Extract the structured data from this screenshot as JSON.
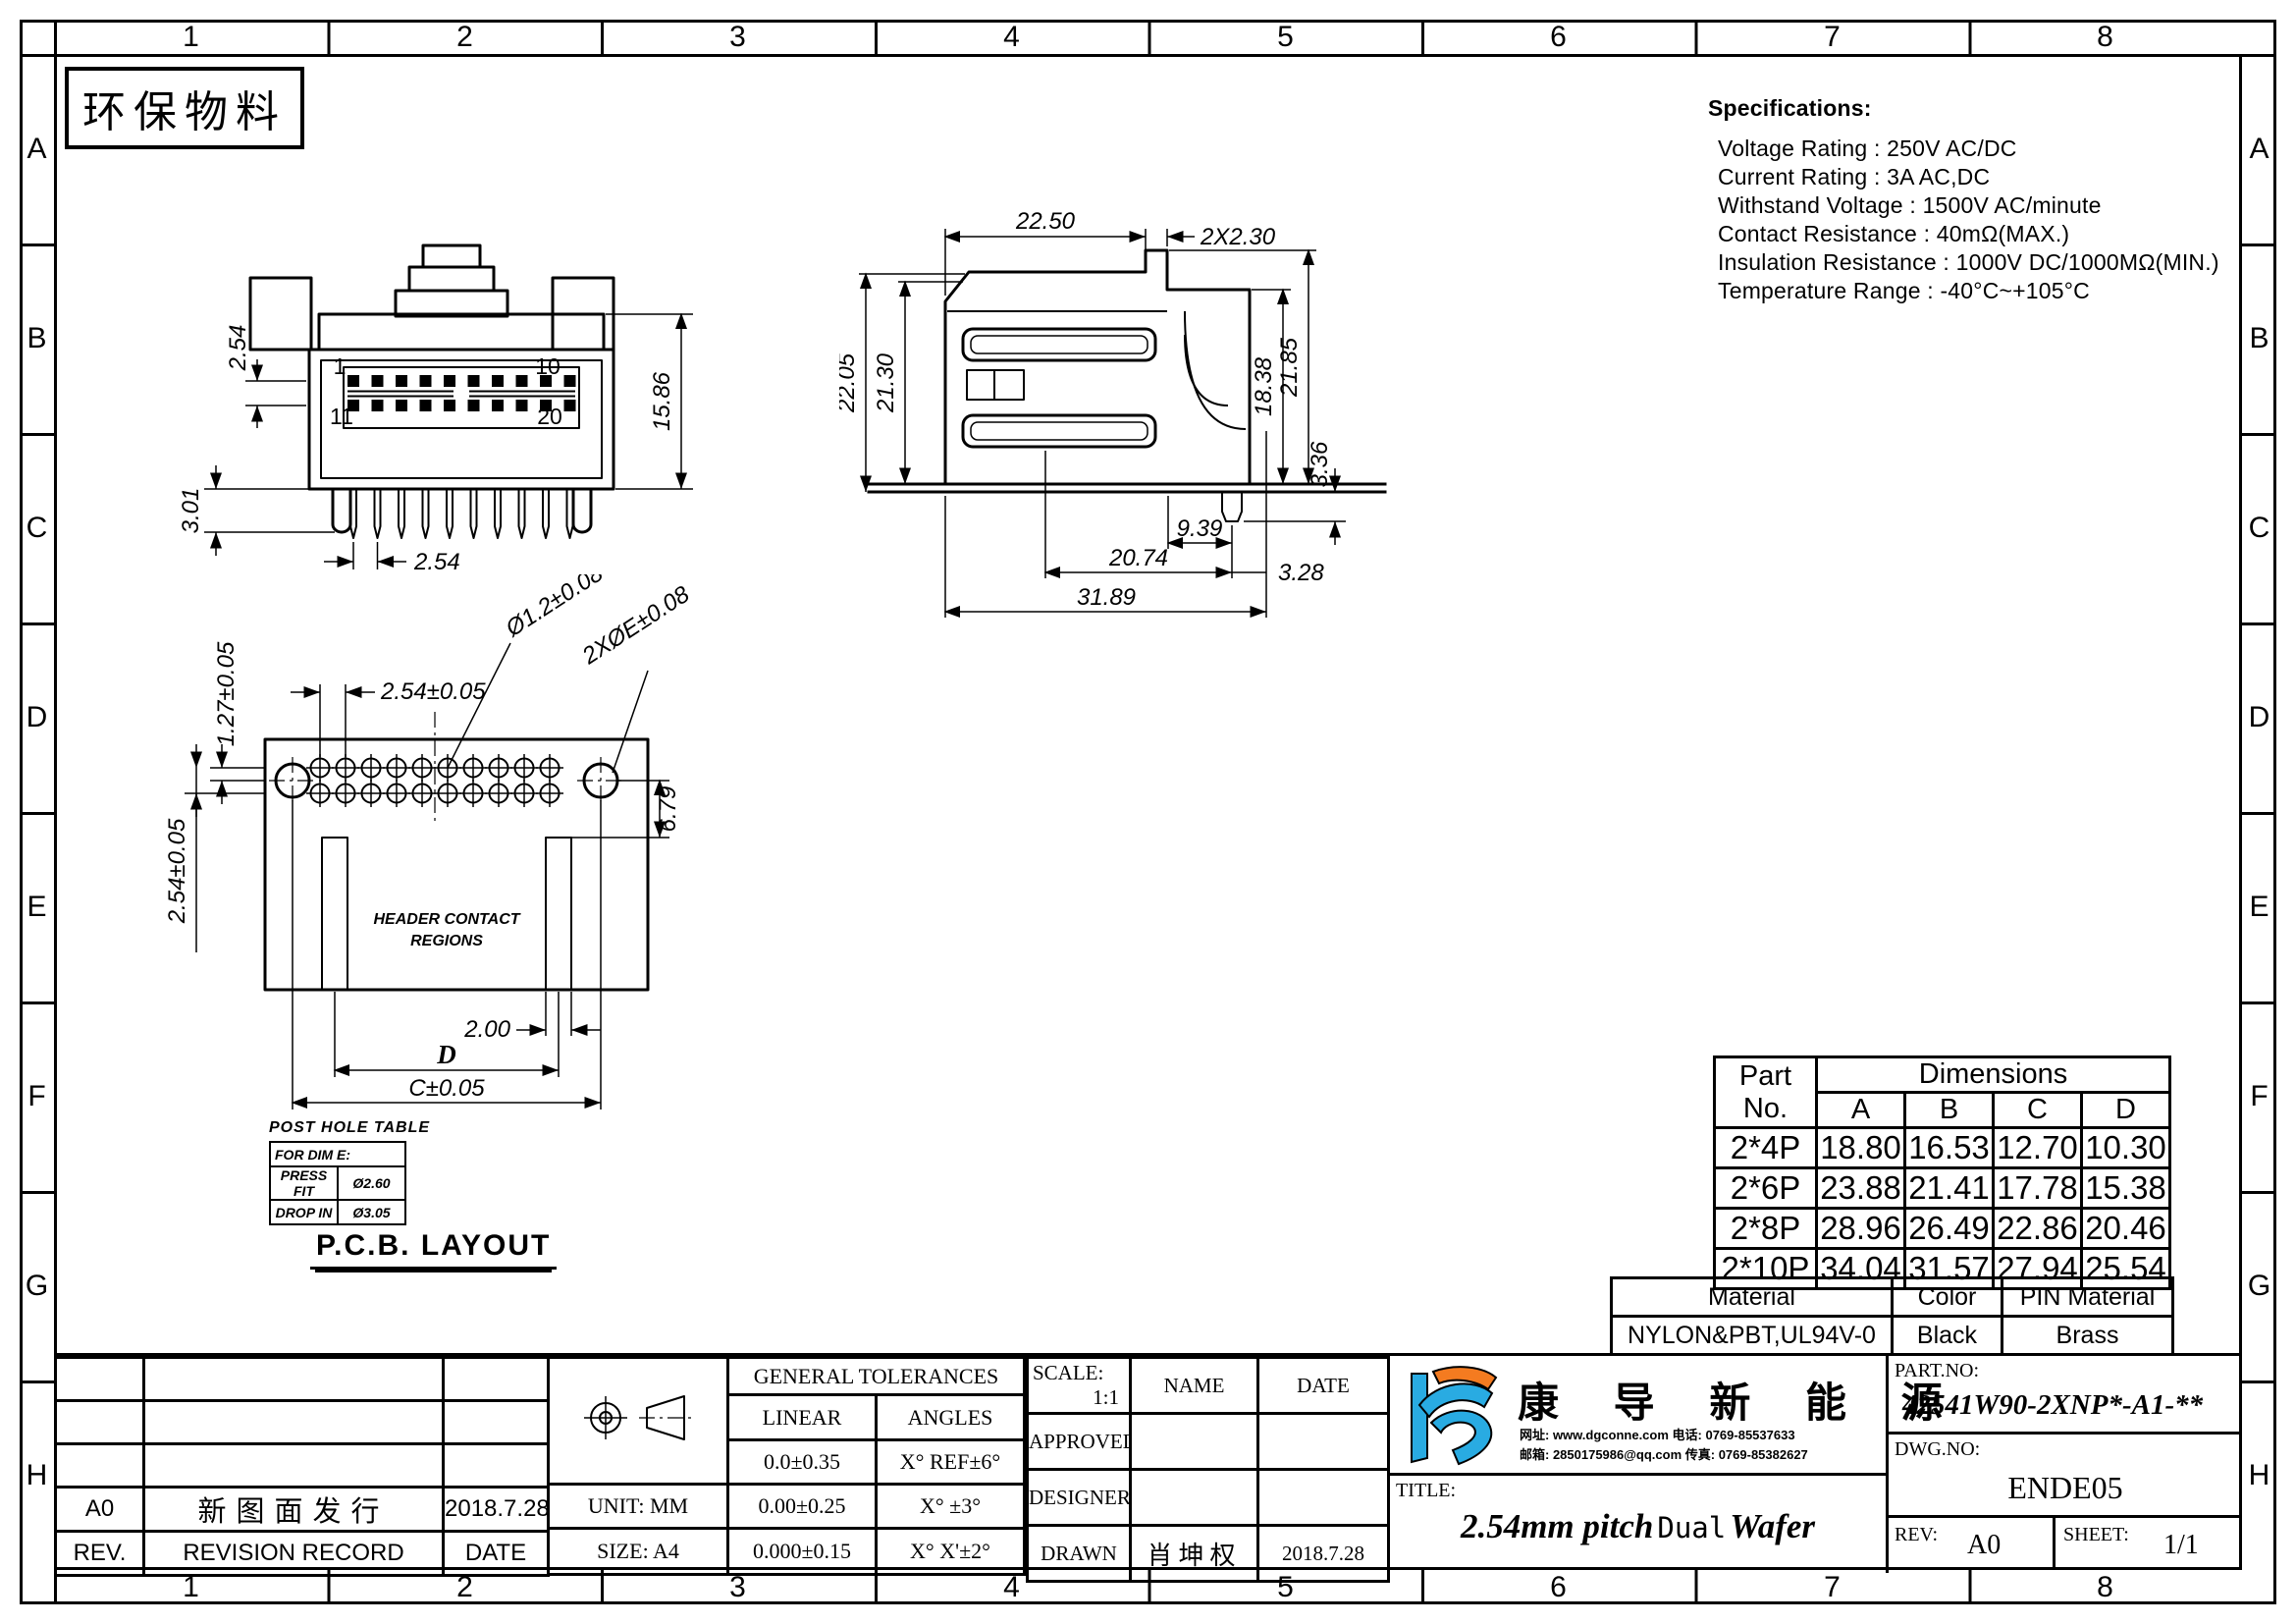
{
  "sheet": {
    "eco_label": "环保物料"
  },
  "border": {
    "cols": [
      "1",
      "2",
      "3",
      "4",
      "5",
      "6",
      "7",
      "8"
    ],
    "rows": [
      "A",
      "B",
      "C",
      "D",
      "E",
      "F",
      "G",
      "H"
    ]
  },
  "specs": {
    "title": "Specifications:",
    "lines": [
      "Voltage Rating : 250V AC/DC",
      "Current Rating : 3A AC,DC",
      "Withstand Voltage : 1500V AC/minute",
      "Contact Resistance : 40mΩ(MAX.)",
      "Insulation Resistance : 1000V DC/1000MΩ(MIN.)",
      "Temperature Range : -40°C~+105°C"
    ]
  },
  "front_view": {
    "dim_row_pitch": "2.54",
    "dim_height": "15.86",
    "dim_pin_length": "3.01",
    "dim_pitch": "2.54",
    "pin1": "1",
    "pin10": "10",
    "pin11": "11",
    "pin20": "20"
  },
  "side_view": {
    "dim_top_width": "22.50",
    "dim_pin_width": "2X2.30",
    "dim_h1": "22.05",
    "dim_h2": "21.30",
    "dim_h3": "18.38",
    "dim_h4": "21.85",
    "dim_peg": "3.36",
    "dim_b1": "9.39",
    "dim_b2": "20.74",
    "dim_b3": "3.28",
    "dim_total": "31.89"
  },
  "pcb": {
    "title": "P.C.B. LAYOUT",
    "region_line1": "HEADER CONTACT",
    "region_line2": "REGIONS",
    "dim_pitch": "2.54±0.05",
    "dim_half_pitch": "1.27±0.05",
    "dim_row": "2.54±0.05",
    "dim_hole": "Ø1.2±0.08",
    "dim_post_hole": "2XØE±0.08",
    "dim_offset": "6.79",
    "dim_pad": "2.00",
    "dim_d": "D",
    "dim_c": "C±0.05",
    "post_hole_table": {
      "title": "POST HOLE TABLE",
      "header": "FOR DIM E:",
      "rows": [
        [
          "PRESS FIT",
          "Ø2.60"
        ],
        [
          "DROP IN",
          "Ø3.05"
        ]
      ]
    }
  },
  "part_table": {
    "col_part": "Part",
    "col_no": "No.",
    "col_dims": "Dimensions",
    "cols": [
      "A",
      "B",
      "C",
      "D"
    ],
    "rows": [
      [
        "2*4P",
        "18.80",
        "16.53",
        "12.70",
        "10.30"
      ],
      [
        "2*6P",
        "23.88",
        "21.41",
        "17.78",
        "15.38"
      ],
      [
        "2*8P",
        "28.96",
        "26.49",
        "22.86",
        "20.46"
      ],
      [
        "2*10P",
        "34.04",
        "31.57",
        "27.94",
        "25.54"
      ]
    ]
  },
  "material_table": {
    "h_material": "Material",
    "h_color": "Color",
    "h_pin": "PIN Material",
    "material": "NYLON&PBT,UL94V-0",
    "color": "Black",
    "pin": "Brass"
  },
  "title_block": {
    "revision": {
      "rev_value": "A0",
      "record_value": "新图面发行",
      "date_value": "2018.7.28",
      "h_rev": "REV.",
      "h_record": "REVISION RECORD",
      "h_date": "DATE"
    },
    "tolerances": {
      "title": "GENERAL TOLERANCES",
      "h_linear": "LINEAR",
      "h_angles": "ANGLES",
      "rows": [
        [
          "0.0±0.35",
          "X° REF±6°"
        ],
        [
          "0.00±0.25",
          "X° ±3°"
        ],
        [
          "0.000±0.15",
          "X° X'±2°"
        ]
      ],
      "unit": "UNIT: MM",
      "size": "SIZE: A4"
    },
    "approval": {
      "scale_label": "SCALE:",
      "scale_value": "1:1",
      "h_name": "NAME",
      "h_date": "DATE",
      "row1": "APPROVED",
      "row2": "DESIGNER",
      "row3": "DRAWN",
      "drawn_name": "肖坤权",
      "drawn_date": "2018.7.28"
    },
    "company": {
      "name": "康 导 新 能 源",
      "contact_line1": "网址: www.dgconne.com   电话: 0769-85537633",
      "contact_line2": "邮箱: 2850175986@qq.com 传真: 0769-85382627",
      "logo_blue": "#29abe2",
      "logo_orange": "#f47b20"
    },
    "title": {
      "label": "TITLE:",
      "part1": "2.54mm pitch",
      "part2": "Dual",
      "part3": "Wafer"
    },
    "drawing": {
      "part_no_label": "PART.NO:",
      "part_no": "42541W90-2XNP*-A1-**",
      "dwg_no_label": "DWG.NO:",
      "dwg_no": "ENDE05",
      "rev_label": "REV:",
      "rev": "A0",
      "sheet_label": "SHEET:",
      "sheet": "1/1"
    }
  }
}
